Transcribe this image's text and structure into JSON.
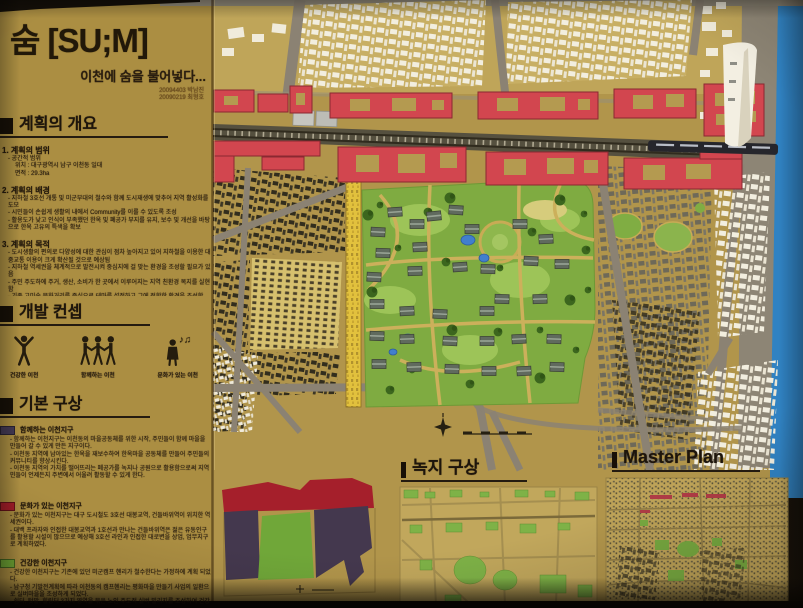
{
  "board": {
    "title": "숨 [SU;M]",
    "subtitle": "이천에 숨을 불어넣다...",
    "credits": [
      "20094403 박남진",
      "20090219 최형호"
    ]
  },
  "overview": {
    "heading": "계획의 개요",
    "scope": {
      "heading": "1. 계획의 범위",
      "lines": [
        "- 공간적 범위",
        "위치 : 대구광역시 남구 이천동 일대",
        "면적 : 29.3ha"
      ]
    },
    "background": {
      "heading": "2. 계획의 배경",
      "lines": [
        "- 지하철 3호선 개통 및 미군부대의 철수와 함께 도시재생에 맞추어 지역 활성화를 도모",
        "- 시민들이 손쉽게 생활의 내에서 Community를 이룰 수 있도록 조성",
        "- 활용도가 낮고 인식이 부족했던 한옥 및 폐공가 부지를 유지, 보수 및 개선을 바탕으로 한옥 고유의 특색을 확보"
      ]
    },
    "purpose": {
      "heading": "3. 계획의 목적",
      "lines": [
        "- 도시생활의 편의로 다양성에 대한 관심이 점차 높아지고 있어 지하철을 이용한 대중교통 이용이 크게 확산될 것으로 예상됨",
        "- 지하철 역세권을 체계적으로 발전시켜 중심지에 걸 맞는 환경을 조성할 필요가 있음",
        "- 주민 주도하에 주거, 생산, 소비가 한 곳에서 이루어지는 지역 친환경 복지를 실현함",
        "- 기존 고미술 문화거리를 중심으로 테마를 설정하고 그에 적합한 환경을 조성함"
      ]
    }
  },
  "concept": {
    "heading": "개발 컨셉",
    "items": [
      {
        "icon": "cheering-person-icon",
        "label": "건강한 이천"
      },
      {
        "icon": "holding-hands-people-icon",
        "label": "함께하는 이천"
      },
      {
        "icon": "singing-person-icon",
        "label": "문화가 있는 이천",
        "music_notes": "♪♫"
      }
    ]
  },
  "basic_plan": {
    "heading": "기본 구상",
    "districts": [
      {
        "color": "#443a55",
        "name": "함께하는 이천지구",
        "lines": [
          "- 함께하는 이천지구는 이천동의 마을공동체를 위한 시작, 주민들이 함께 마을을 만들어 갈 수 있게 만든 지구이다.",
          "- 이천동 지역에 남아있는 한옥을 재보수하여 한옥마을 공동체를 만들어 주민들의 커뮤니티를 향상시킨다.",
          "- 이천동 지역의 가치를 떨어뜨리는 폐공가를 녹지나 공원으로 활용함으로써 지역민들이 언제든지 주변에서 어울려 활동할 수 있게 한다."
        ]
      },
      {
        "color": "#a81e2a",
        "name": "문화가 있는 이천지구",
        "lines": [
          "- 문화가 있는 이천지구는 대구 도시철도 3호선 대봉교역, 건들바위역이 위치한 역세권이다.",
          "- 대백 프라자와 인접한 대봉교역과 1호선과 만나는 건들바위역은 젊은 유동인구를 활용할 시설이 많으므로 예상해 3호선 라인과 인접한 대로변을 상업, 업무지구로 계획하였다."
        ]
      },
      {
        "color": "#6fa836",
        "name": "건강한 이천지구",
        "lines": [
          "- 건강한 이천지구는 기존에 있던 미군캠프 헨리가 철수한다는 가정하에 계획 되었다.",
          "- 남구청 기발전계획에 따라 이천동의 캠프헨리는 평화마을 만들기 사업의 일환으로 실버마을을 조성하게 되었다.",
          "- 쉼터, 텃밭, 힐링터 3가지 영역을 묶은 노인 주도적 실버 빌리지를 조성하여 건강한 노년 생활을 보낼 수 있는 단지로 계획하였다."
        ]
      }
    ]
  },
  "green_plan": {
    "heading": "녹지 구상"
  },
  "master_plan": {
    "heading": "Master Plan"
  },
  "model": {
    "colors": {
      "board_tan": "#b29549",
      "culture_axis_red": "#d5454e",
      "park_green": "#7eac3e",
      "pond_blue": "#3f7fd0",
      "road_grey": "#8b8272",
      "railway_dark": "#55503e",
      "white_buildings": "#f2eedf",
      "background_wall_blue": "#2e82c4",
      "golden_wall": "#e3c139"
    }
  }
}
